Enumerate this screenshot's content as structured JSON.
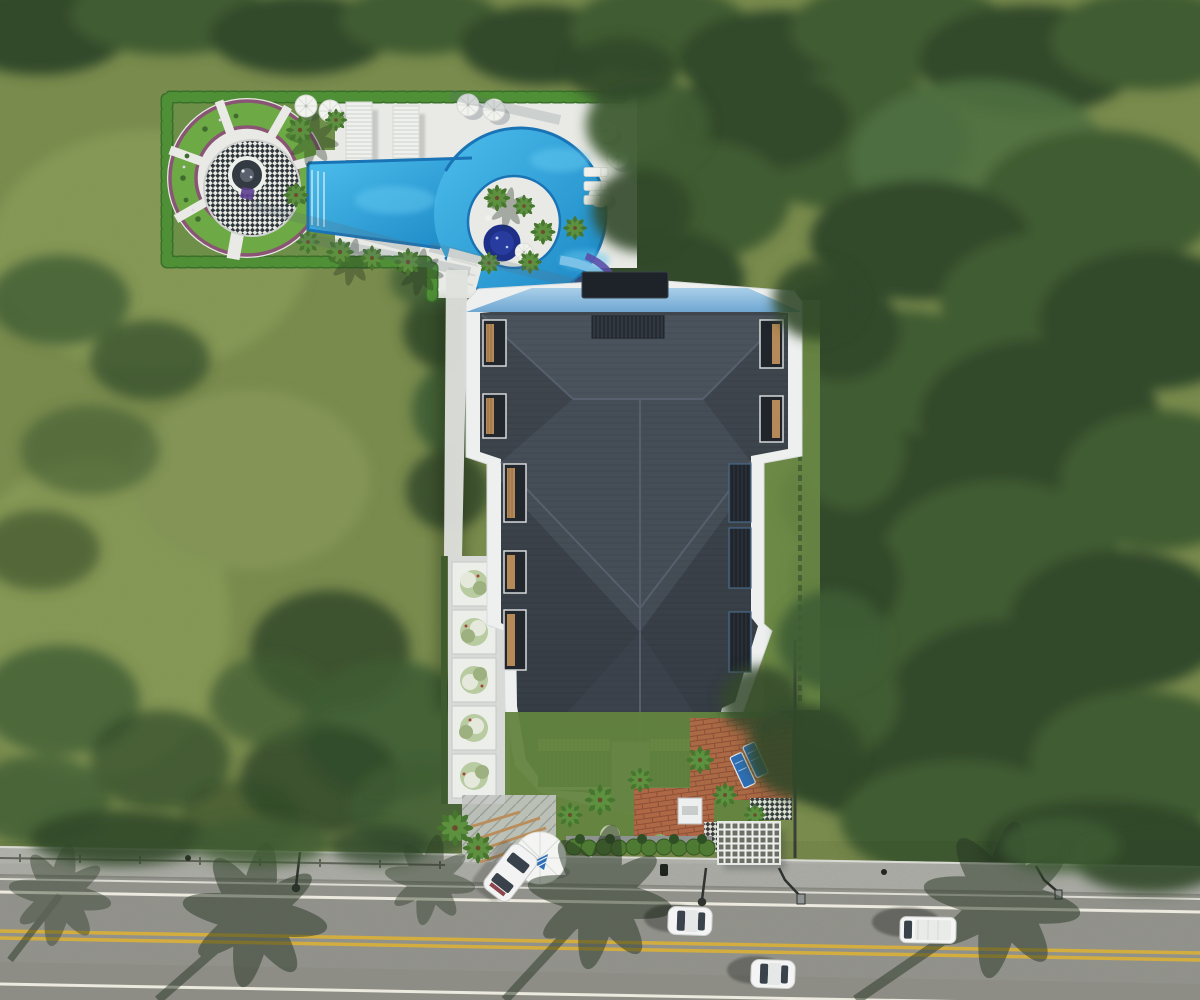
{
  "scene": {
    "view": "top-down aerial 3D architectural rendering",
    "site": "Landscaped residential parcel with an apartment building and pool amenity garden set in meadow and dense tree canopy, fronting a two-lane road",
    "areas": {
      "pool_amenity": {
        "label": "pool and garden amenity area",
        "features": [
          "scalloped hedge border",
          "circular parterre garden with checkered mosaic plaza and central fountain",
          "free-form swimming pool with lazy-river loop",
          "round jacuzzi on island",
          "water slide",
          "two timber-slat lounger pergolas",
          "sun umbrellas",
          "palm trees",
          "white paved sun deck"
        ]
      },
      "building": {
        "label": "apartment building",
        "features": [
          "dark hipped shingle roof with ridge lines",
          "rooftop service box",
          "light blue canopy along north edge",
          "recessed side balconies with timber decks",
          "two recessed south balconies",
          "white parapet trim"
        ]
      },
      "grounds": {
        "label": "grounds",
        "features": [
          "west walkway with square planters and silver shrubs",
          "entrance lawn with brick path",
          "clipped hedge row at street",
          "round entrance canopy with blue logo",
          "white lattice pergola",
          "brick patio with two blue loungers"
        ]
      },
      "street": {
        "label": "street frontage",
        "features": [
          "concrete sidewalk",
          "two-lane asphalt road",
          "double yellow centerline",
          "white edge lines",
          "street lamps",
          "long palm-tree shadows across the road"
        ]
      }
    },
    "vehicles": {
      "parked_at_entrance": 1,
      "on_road": 3,
      "types": [
        "white sedan (parked, angled)",
        "white sedan",
        "white sedan",
        "white van"
      ]
    },
    "counts": {
      "umbrellas": 7,
      "pergola_bays": 2,
      "planter_trees_west_walk": 5,
      "street_lamps": 4,
      "bottom_balconies": 2
    }
  },
  "colors": {
    "grass": "#7c8e4f",
    "tree_dark": "#31492a",
    "tree_mid": "#3f5c33",
    "hedge": "#4f8f36",
    "deck": "#e9eae6",
    "pool_water": "#2aa0dc",
    "pool_edge": "#1973b4",
    "jacuzzi": "#1d2f86",
    "roof": "#3b424a",
    "roof_ridge": "#596270",
    "canopy_blue": "#8ebfe2",
    "trim_white": "#eef0f0",
    "wood": "#c59c6a",
    "brick": "#ae6846",
    "lawn": "#63843f",
    "sidewalk": "#b2b3ac",
    "asphalt": "#94948e",
    "lane_yellow": "#d3ae3f",
    "lane_white": "#eceade",
    "vehicle_white": "#f3f4f3",
    "logo_blue": "#2f6fb8"
  }
}
